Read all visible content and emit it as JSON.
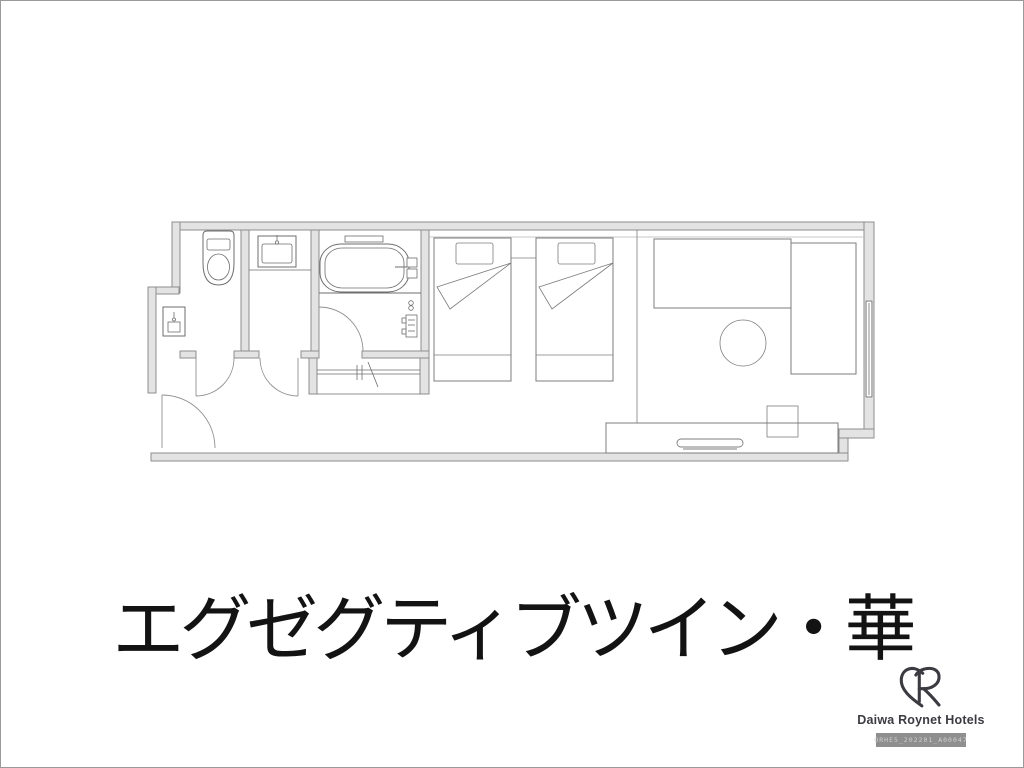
{
  "page": {
    "background": "#ffffff",
    "border": "#9a9a9a"
  },
  "title": {
    "text": "エグゼグティブツイン・華",
    "color": "#131313"
  },
  "floorplan": {
    "wall_fill": "#e3e3e3",
    "wall_stroke": "#8e8e8e",
    "fixture_stroke": "#6e6e6e",
    "furniture_stroke": "#7d7d7d",
    "door_stroke": "#909090",
    "thin_line": "#b5b5b5",
    "elements": [
      "toilet",
      "vanity-sink",
      "bathtub",
      "shower-panel",
      "utility-sink",
      "closet-rail",
      "bed-1",
      "bed-2",
      "sofa-long",
      "sofa-side",
      "round-table",
      "desk",
      "tv-on-desk",
      "stool",
      "window",
      "entrance-door",
      "toilet-door",
      "vanity-door",
      "bathroom-door"
    ]
  },
  "logo": {
    "brand": "Daiwa Roynet Hotels",
    "code": "DRHE5_202201_A00047",
    "color": "#3b3b41",
    "code_bg": "#8f8f8f",
    "code_color": "#d0d0d0"
  }
}
